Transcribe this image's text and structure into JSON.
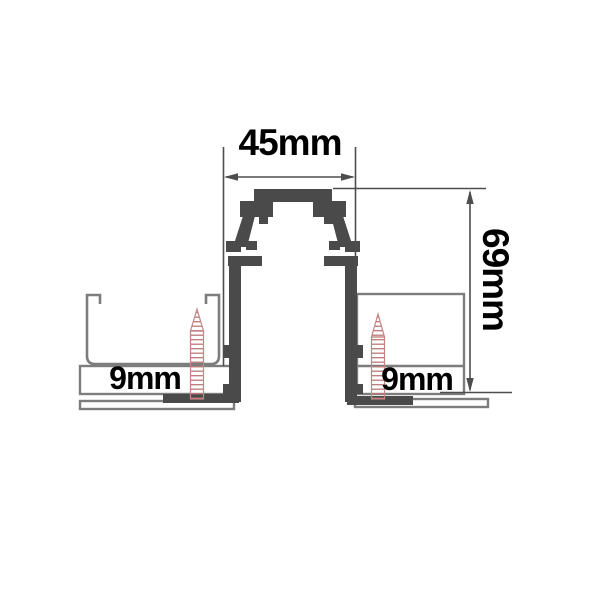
{
  "diagram": {
    "labels": {
      "width_top": "45mm",
      "height_right": "69mm",
      "thickness_left": "9mm",
      "thickness_right": "9mm"
    },
    "colors": {
      "profile": "#4a4a4a",
      "outline": "#7d7d7d",
      "dimension": "#4d4d4d",
      "screw": "#c58484",
      "screw_thread": "#bd7676",
      "background": "#ffffff",
      "text": "#000000"
    }
  }
}
